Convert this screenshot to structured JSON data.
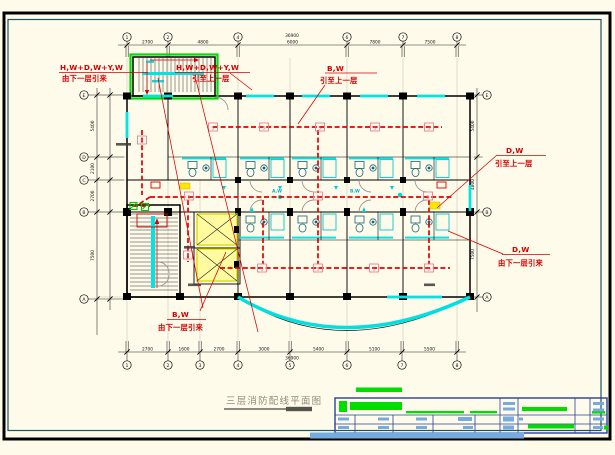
{
  "sheet": {
    "background": "#FFFBEA",
    "outer_frame_color": "#000000",
    "inner_frame_color": "#1A5566",
    "highlight_green": "#00DC00",
    "wiring_red": "#E00000",
    "window_cyan": "#00E4E4",
    "elevator_yellow": "#FFFB9E",
    "titleblock_blue": "#76ABE0"
  },
  "title": {
    "text": "三层消防配线平面图"
  },
  "annotations": {
    "top_left": {
      "line1": "H,W+D,W+Y,W",
      "line2": "由下一层引来"
    },
    "top_mid": {
      "line1": "H,W+D,W+Y,W",
      "line2": "引至上一层"
    },
    "bw_top": {
      "line1": "B,W",
      "line2": "引至上一层"
    },
    "dw_upper_right": {
      "line1": "D,W",
      "line2": "引至上一层"
    },
    "dw_lower_right": {
      "line1": "D,W",
      "line2": "由下一层引来"
    },
    "bw_bottom": {
      "line1": "B,W",
      "line2": "由下一层引来"
    }
  },
  "plan": {
    "detector": "S",
    "wire_a": "A,W",
    "wire_b": "B,W"
  },
  "grid": {
    "top": [
      "1",
      "2",
      "4",
      "6",
      "7",
      "8"
    ],
    "bottom": [
      "1",
      "2",
      "3",
      "4",
      "5",
      "6",
      "7",
      "8"
    ],
    "left": [
      "E",
      "D",
      "C",
      "B",
      "A"
    ],
    "right": [
      "E",
      "B",
      "A"
    ]
  },
  "dims": {
    "top": [
      "2700",
      "4800",
      "6000",
      "7800",
      "7500"
    ],
    "top_total": "36900",
    "bottom": [
      "2700",
      "1600",
      "2700",
      "3000",
      "5400",
      "5100",
      "5500"
    ],
    "bottom_total": "36900",
    "left": [
      "5400",
      "2100",
      "2700",
      "7500"
    ],
    "right": [
      "5400",
      "4800",
      "7500"
    ]
  }
}
